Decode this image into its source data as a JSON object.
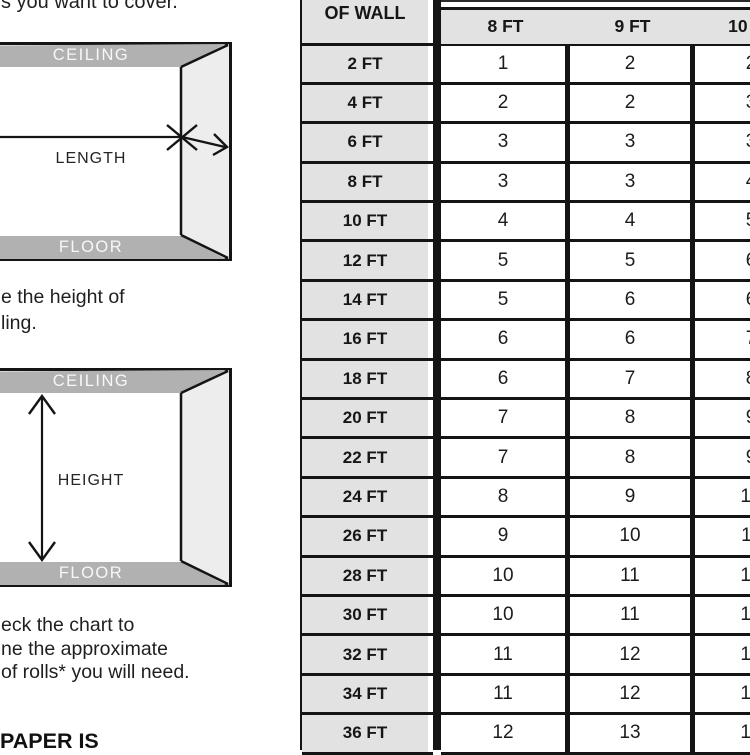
{
  "page": {
    "intro_text_fragment": "s you want to cover.",
    "step2_fragment_lines": [
      "e the height of",
      "ling."
    ],
    "step3_fragment_lines": [
      "eck the chart to",
      "ne the approximate",
      "of rolls* you will need."
    ],
    "bottom_heading_fragment": "PAPER IS"
  },
  "diagrams": {
    "length": {
      "ceiling": "CEILING",
      "floor": "FLOOR",
      "dimension": "LENGTH"
    },
    "height": {
      "ceiling": "CEILING",
      "floor": "FLOOR",
      "dimension": "HEIGHT"
    }
  },
  "chart_data": {
    "type": "table",
    "row_header_fragment": "OF WALL",
    "columns": [
      "8 FT",
      "9 FT",
      "10 FT"
    ],
    "row_labels": [
      "2 FT",
      "4 FT",
      "6 FT",
      "8 FT",
      "10 FT",
      "12 FT",
      "14 FT",
      "16 FT",
      "18 FT",
      "20 FT",
      "22 FT",
      "24 FT",
      "26 FT",
      "28 FT",
      "30 FT",
      "32 FT",
      "34 FT",
      "36 FT"
    ],
    "series": [
      {
        "name": "8 FT",
        "values": [
          1,
          2,
          3,
          3,
          4,
          5,
          5,
          6,
          6,
          7,
          7,
          8,
          9,
          10,
          10,
          11,
          11,
          12
        ]
      },
      {
        "name": "9 FT",
        "values": [
          2,
          2,
          3,
          3,
          4,
          5,
          6,
          6,
          7,
          8,
          8,
          9,
          10,
          11,
          11,
          12,
          12,
          13
        ]
      },
      {
        "name": "10 FT",
        "values": [
          2,
          3,
          3,
          4,
          5,
          6,
          6,
          7,
          8,
          9,
          9,
          10,
          11,
          12,
          12,
          13,
          13,
          14
        ]
      }
    ]
  },
  "colors": {
    "table_cell_gray": "#e2e2e2",
    "ceiling_floor_bar_gray": "#b1b1b1",
    "side_wall_gray": "#ededed",
    "line_black": "#141414"
  }
}
